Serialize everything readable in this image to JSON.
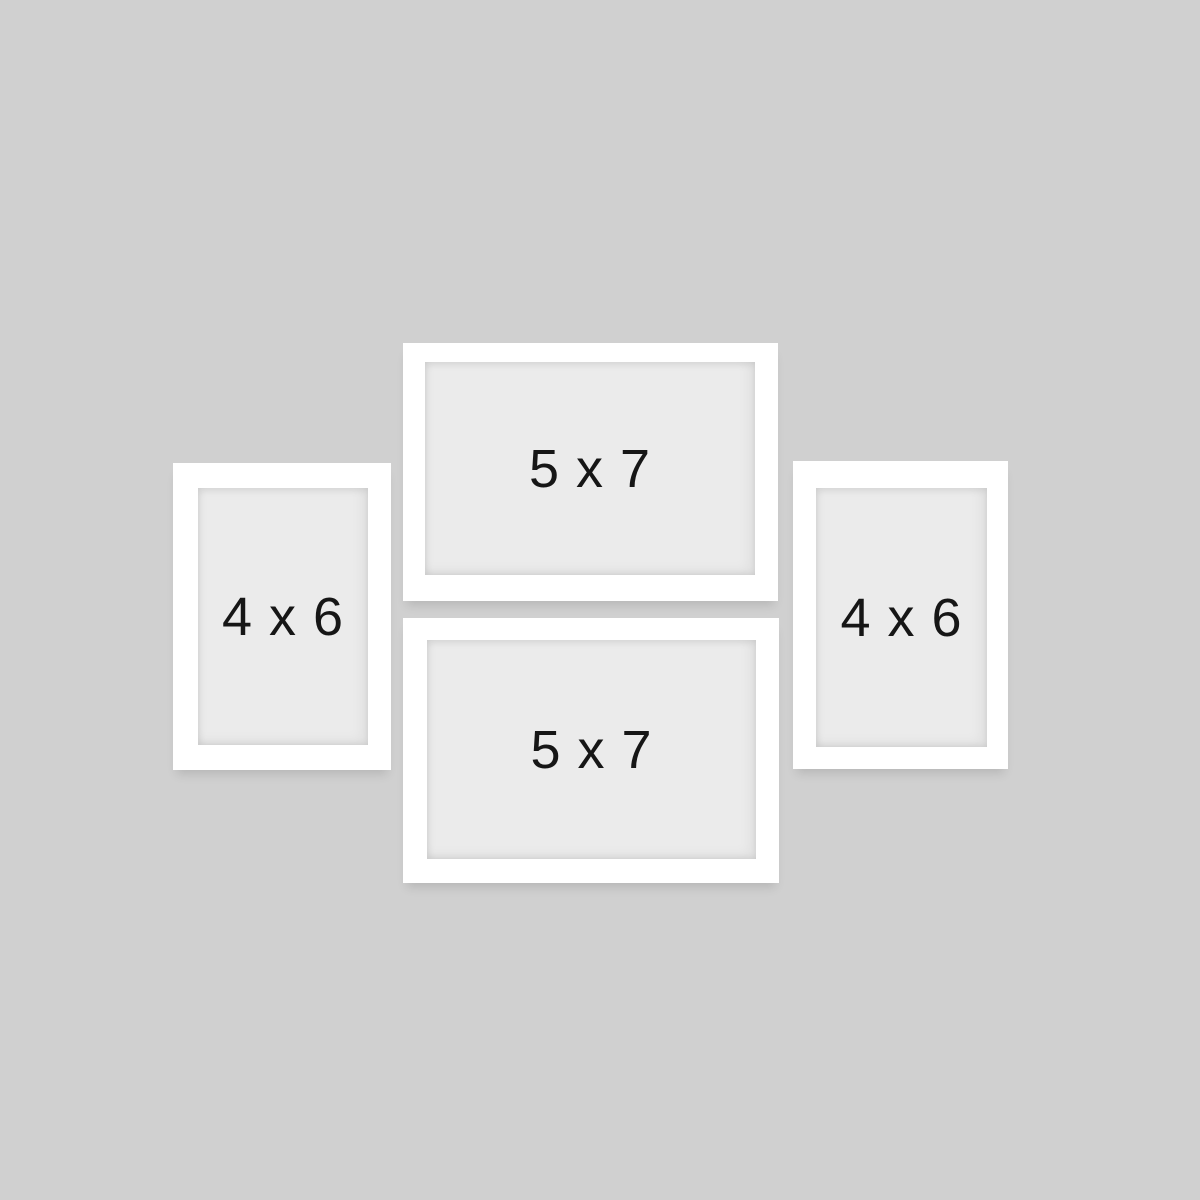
{
  "scene": {
    "description": "Four-piece white gallery picture frame set displayed on a gray wall",
    "colors": {
      "background": "#d0d0d0",
      "frame": "#ffffff",
      "matte": "#ebebeb",
      "label_text": "#161616"
    }
  },
  "frames": [
    {
      "id": "frame-5x7-top",
      "label": "5 x 7",
      "orientation": "landscape"
    },
    {
      "id": "frame-4x6-left",
      "label": "4 x 6",
      "orientation": "portrait"
    },
    {
      "id": "frame-4x6-right",
      "label": "4 x 6",
      "orientation": "portrait"
    },
    {
      "id": "frame-5x7-bottom",
      "label": "5 x 7",
      "orientation": "landscape"
    }
  ]
}
